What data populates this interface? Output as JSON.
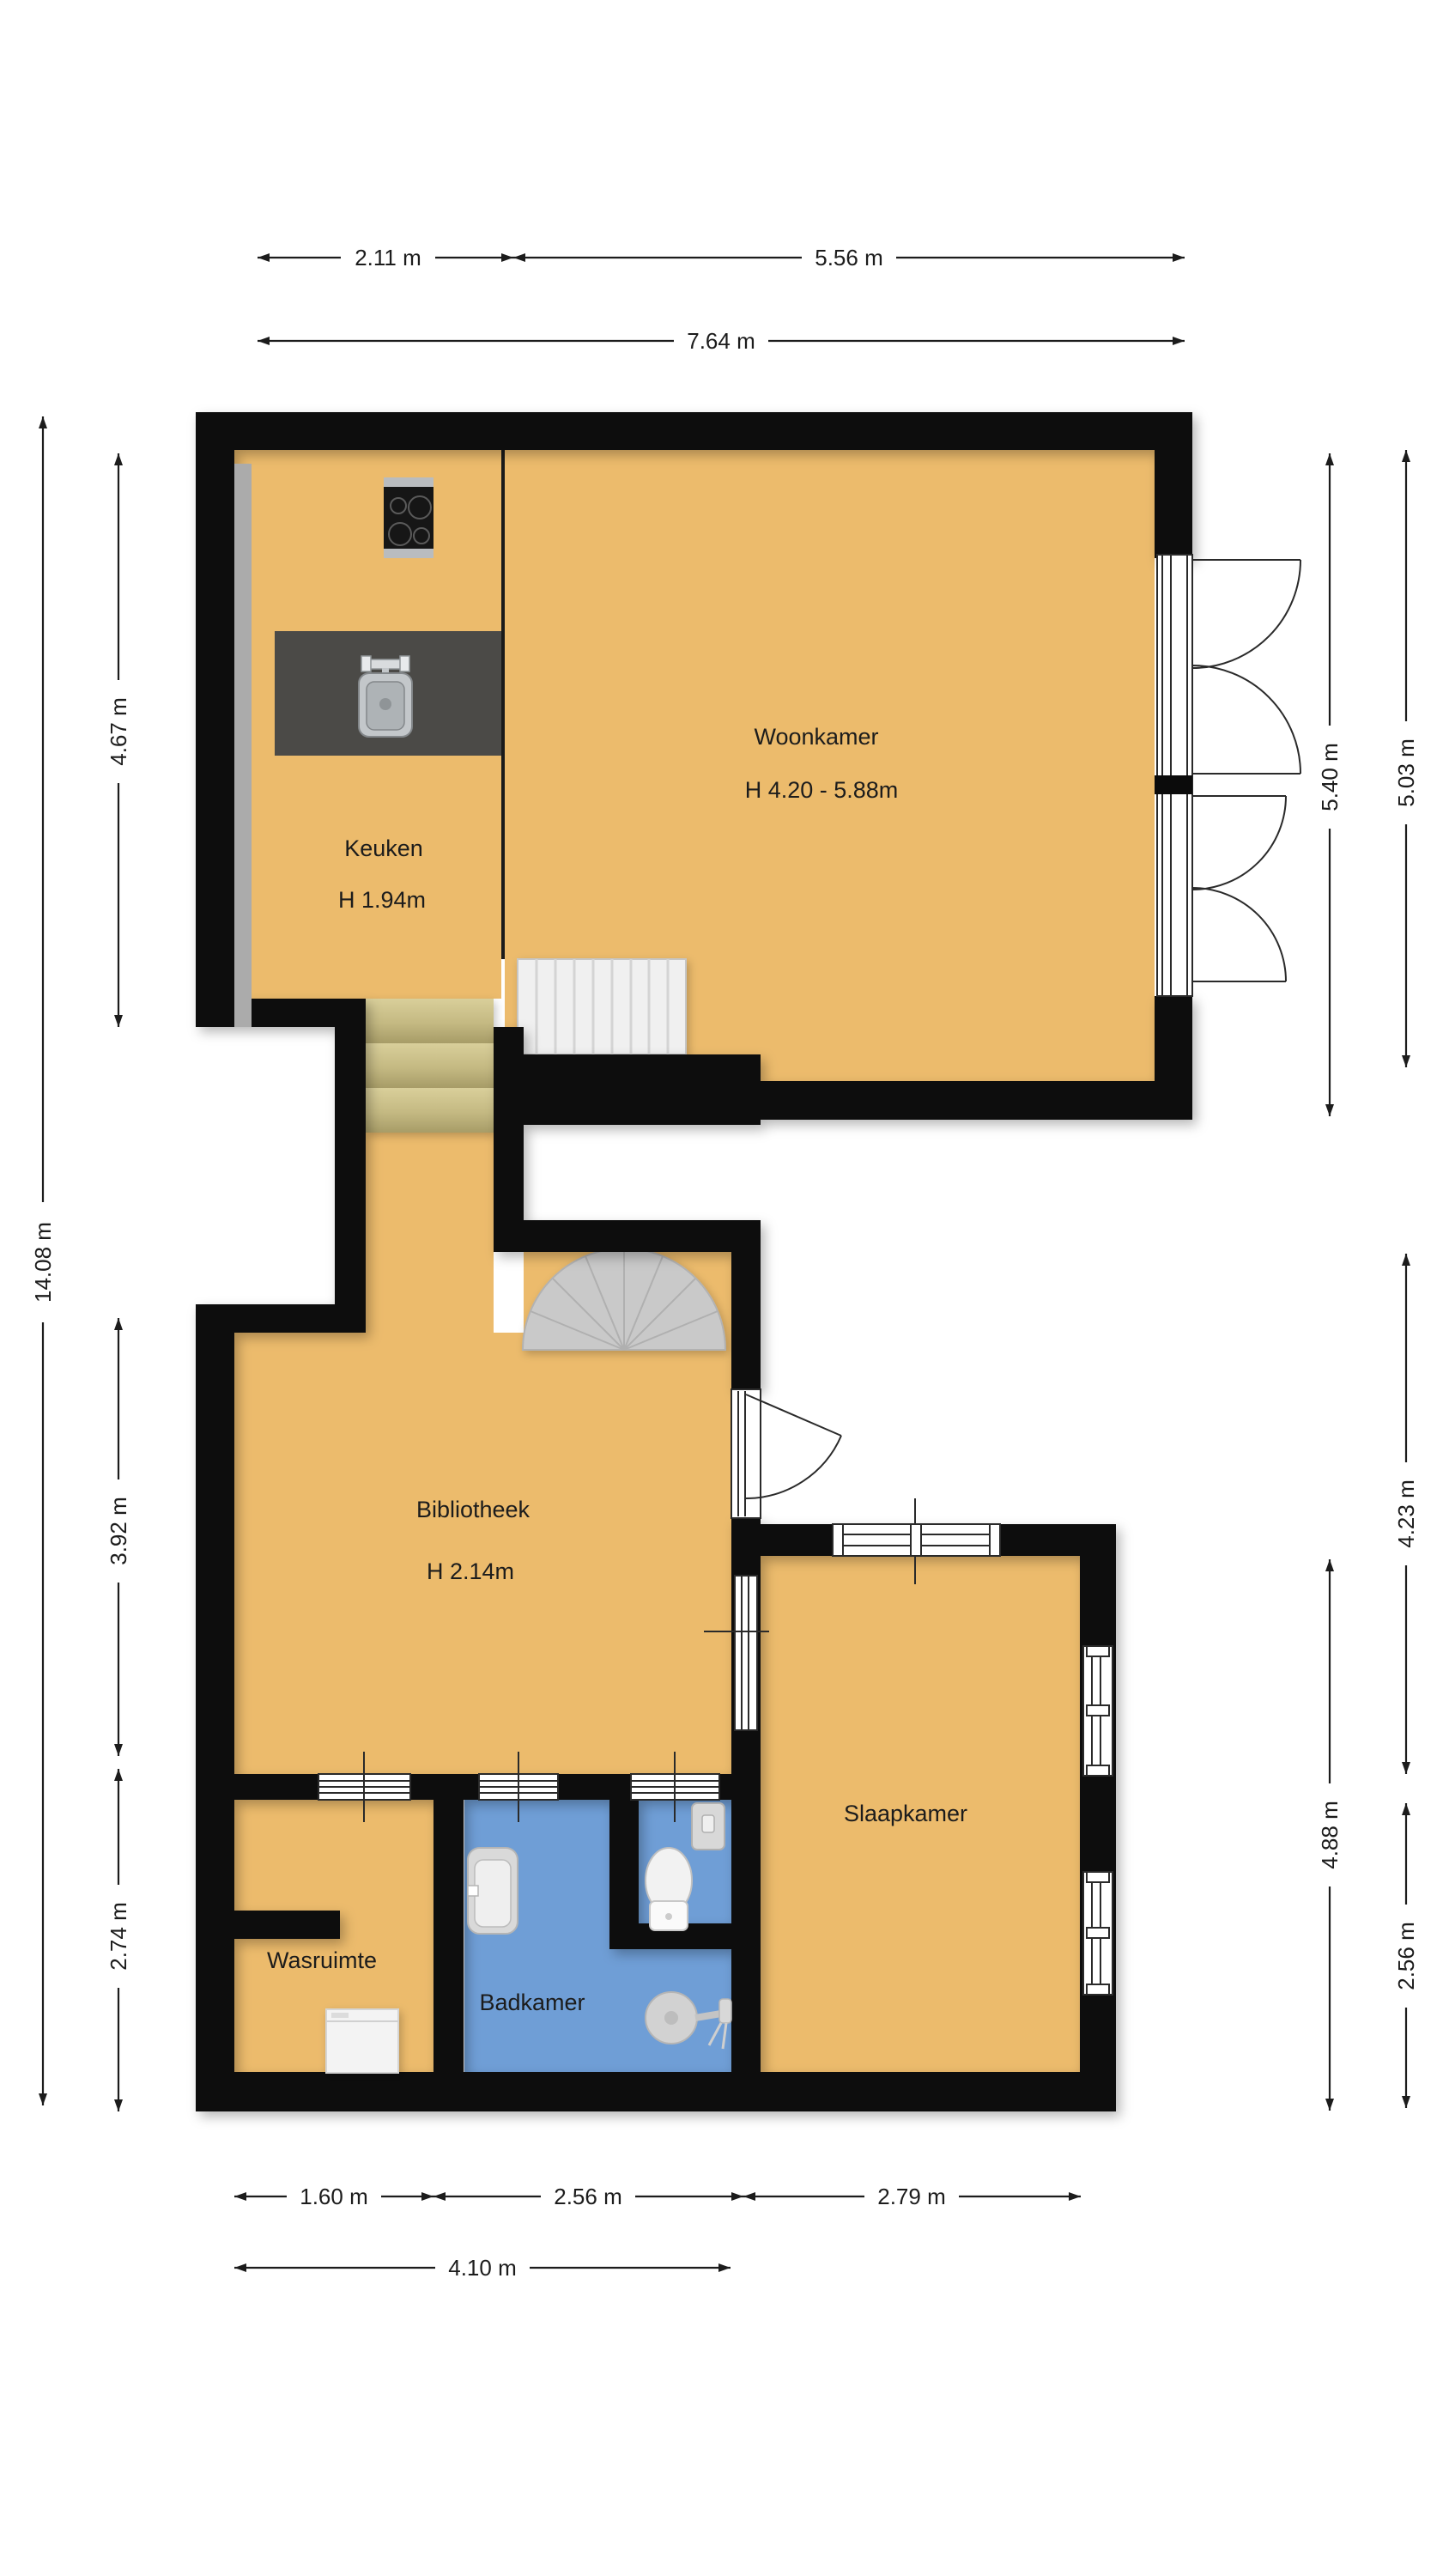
{
  "title": "Floor plan",
  "colors": {
    "floor": "#ecbb6c",
    "wet_floor": "#6f9ed6",
    "wall": "#0b0b0b",
    "stairs": "#efefef",
    "wood_steps": "#cfc48e",
    "counter": "#4b4a47",
    "spiral_stairs": "#c9c9c9",
    "dimension_lines": "#1c1c1c"
  },
  "rooms": {
    "woonkamer": {
      "label": "Woonkamer",
      "height_label": "H 4.20 - 5.88m"
    },
    "keuken": {
      "label": "Keuken",
      "height_label": "H 1.94m"
    },
    "bibliotheek": {
      "label": "Bibliotheek",
      "height_label": "H 2.14m"
    },
    "slaapkamer": {
      "label": "Slaapkamer"
    },
    "wasruimte": {
      "label": "Wasruimte"
    },
    "badkamer": {
      "label": "Badkamer"
    }
  },
  "dimensions": {
    "top": {
      "keuken_width": "2.11 m",
      "woonkamer_width": "5.56 m",
      "total_width": "7.64 m"
    },
    "left": {
      "total_height": "14.08 m",
      "keuken_height": "4.67 m",
      "bibliotheek_height": "3.92 m",
      "wasruimte_height": "2.74 m"
    },
    "right": {
      "woonkamer_height_inner": "5.40 m",
      "woonkamer_height_outer": "5.03 m",
      "bibliotheek_right_height": "4.23 m",
      "slaapkamer_height": "4.88 m",
      "badkamer_right_height": "2.56 m"
    },
    "bottom": {
      "wasruimte_width": "1.60 m",
      "badkamer_width": "2.56 m",
      "slaapkamer_width": "2.79 m",
      "left_total_width": "4.10 m"
    }
  },
  "icons": [
    "stove-icon",
    "kitchen-sink-icon",
    "kitchen-counter",
    "straight-stairs",
    "wood-steps",
    "spiral-stairs",
    "french-doors-icon",
    "door-icon",
    "window-icon",
    "toilet-icon",
    "washbasin-icon",
    "shower-icon",
    "washing-machine-icon"
  ]
}
